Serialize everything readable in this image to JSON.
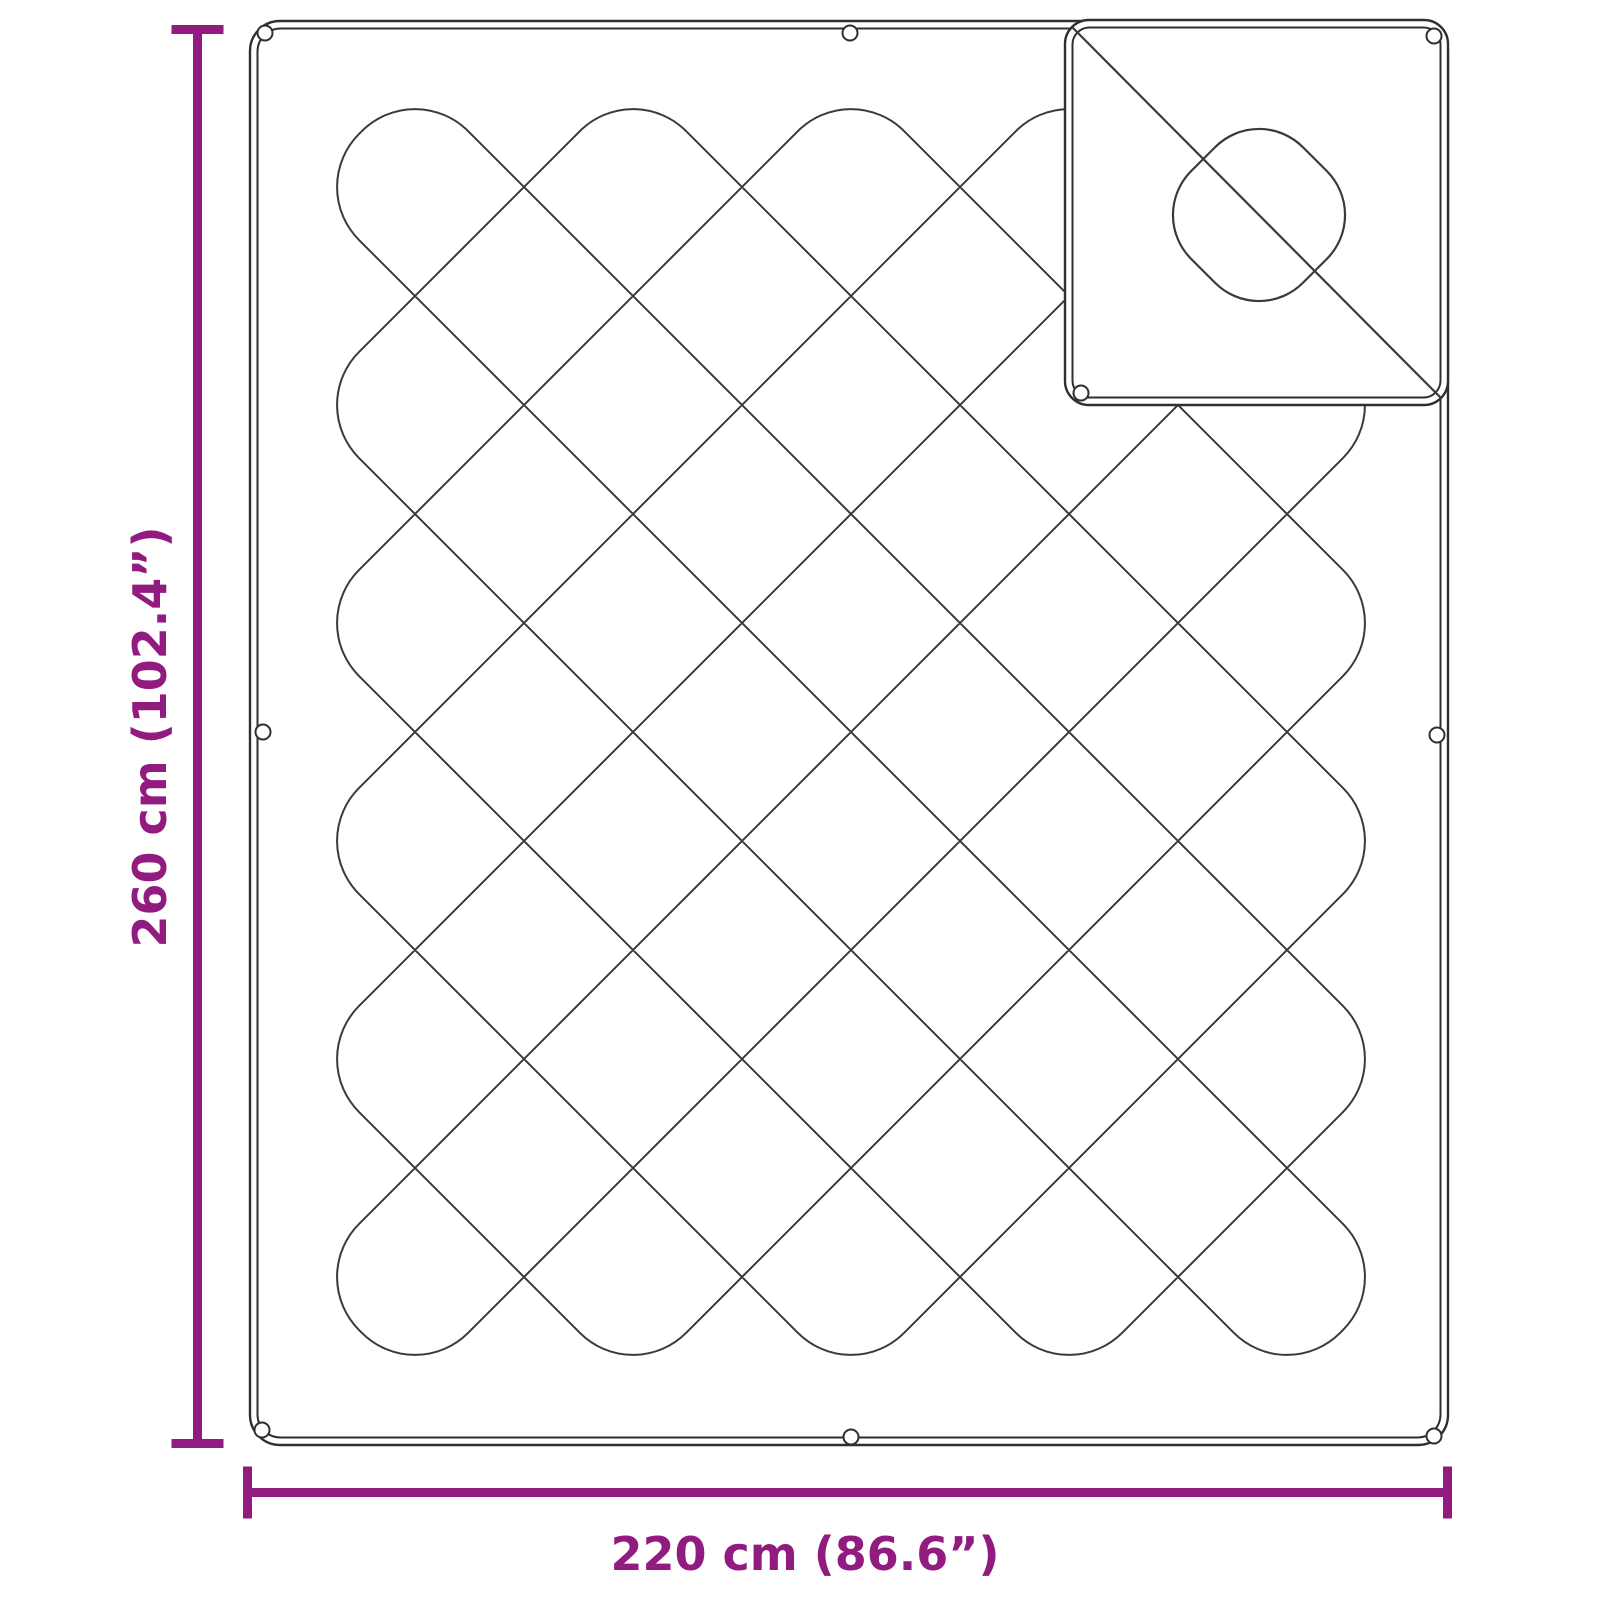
{
  "diagram": {
    "type": "product-dimension-diagram",
    "subject": "quilted blanket with folded corner flap",
    "height_cm": 260,
    "height_inches": 102.4,
    "width_cm": 220,
    "width_inches": 86.6
  },
  "labels": {
    "height": "260 cm (102.4”)",
    "width": "220 cm (86.6”)"
  },
  "colors": {
    "dimension": "#921b7f",
    "outline": "#2f2f2f",
    "stitch": "#3a3a3a",
    "background": "#ffffff"
  },
  "geometry": {
    "canvas": {
      "w": 1600,
      "h": 1600
    },
    "blanket": {
      "x": 250,
      "y": 21,
      "w": 1198,
      "h": 1424,
      "corner_radius": 30,
      "border_gap": 7.5,
      "inner_radius": 23
    },
    "pattern": {
      "x0": 306,
      "y0": 78,
      "step": 109,
      "cols": 10,
      "rows": 12,
      "loop_radius": 75
    },
    "flap": {
      "x": 1065,
      "y": 20,
      "w": 383,
      "h": 385,
      "corner_radius": 24,
      "border_gap": 7.5,
      "inner_radius": 17,
      "fold_line": {
        "x1": 1072,
        "y1": 27,
        "x2": 1441,
        "y2": 398
      },
      "motif": {
        "cx": 1259,
        "cy": 215,
        "size": 158,
        "radius": 62,
        "rotation": 45
      }
    },
    "eyelets": {
      "radius": 7.5,
      "main": [
        [
          265,
          33
        ],
        [
          850,
          33
        ],
        [
          263,
          732
        ],
        [
          262,
          1430
        ],
        [
          851,
          1437
        ],
        [
          1437,
          735
        ],
        [
          1434,
          1436
        ]
      ],
      "flap": [
        [
          1434,
          36
        ],
        [
          1081,
          393
        ]
      ]
    },
    "dimension_v": {
      "line_x": 197.5,
      "y1": 25,
      "y2": 1448,
      "thickness": 9,
      "cap_len": 52,
      "label_x": 166,
      "label_y": 737,
      "label_rotation": -90
    },
    "dimension_h": {
      "line_y": 1492.5,
      "x1": 247.5,
      "x2": 1447.5,
      "thickness": 9,
      "cap_len": 52,
      "label_x": 805,
      "label_y": 1570
    }
  }
}
